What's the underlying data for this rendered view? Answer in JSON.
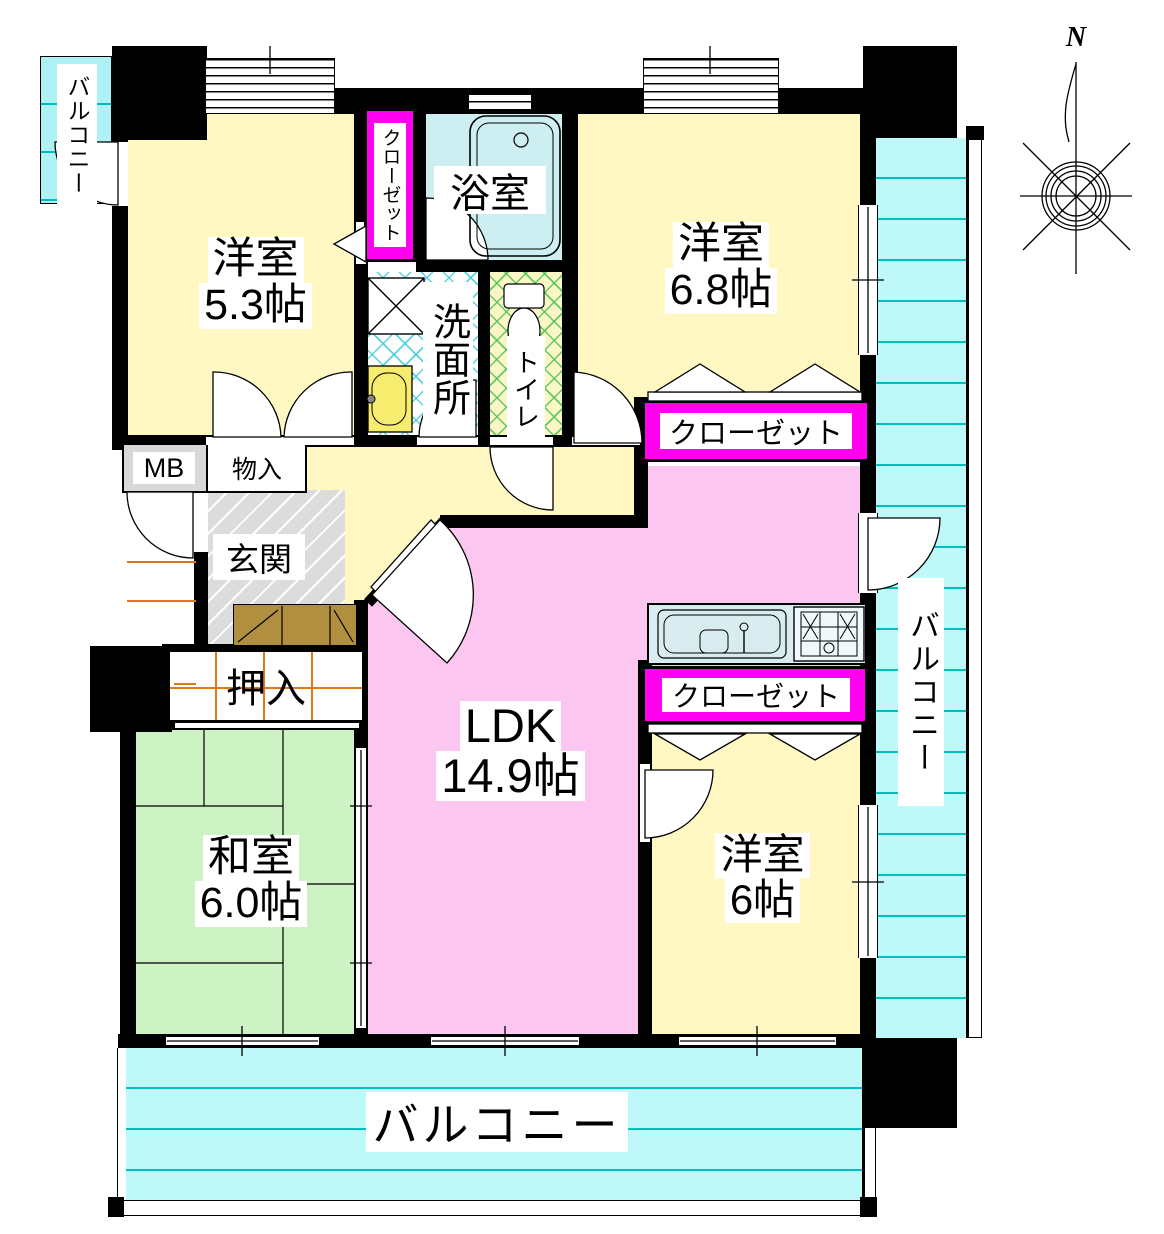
{
  "compass": {
    "north_label": "N"
  },
  "rooms": {
    "bedroom_nw": {
      "name": "洋室",
      "size": "5.3帖"
    },
    "bedroom_ne": {
      "name": "洋室",
      "size": "6.8帖"
    },
    "bedroom_se": {
      "name": "洋室",
      "size": "6帖"
    },
    "japanese_room": {
      "name": "和室",
      "size": "6.0帖"
    },
    "ldk": {
      "name": "LDK",
      "size": "14.9帖"
    },
    "bath": {
      "name": "浴室"
    },
    "washroom": {
      "name": "洗面所"
    },
    "toilet": {
      "name": "トイレ"
    },
    "entrance": {
      "name": "玄関"
    }
  },
  "storage": {
    "closet_nw": {
      "name": "クローゼット"
    },
    "closet_ne": {
      "name": "クローゼット"
    },
    "closet_se": {
      "name": "クローゼット"
    },
    "oshiire": {
      "name": "押入"
    },
    "storage_box": {
      "name": "物入"
    },
    "meter_box": {
      "name": "MB"
    }
  },
  "balconies": {
    "top_left": {
      "name": "バルコニー"
    },
    "right": {
      "name": "バルコニー"
    },
    "bottom": {
      "name": "バルコニー"
    }
  },
  "colors": {
    "western_room": "#FFF8C2",
    "ldk": "#FBC7F0",
    "japanese_room": "#CDF2C4",
    "balcony": "#BFF8F8",
    "bath": "#CDEFF2",
    "closet_accent": "#FF00F0",
    "entrance_tile": "#DCDCDC",
    "wall": "#000000"
  }
}
